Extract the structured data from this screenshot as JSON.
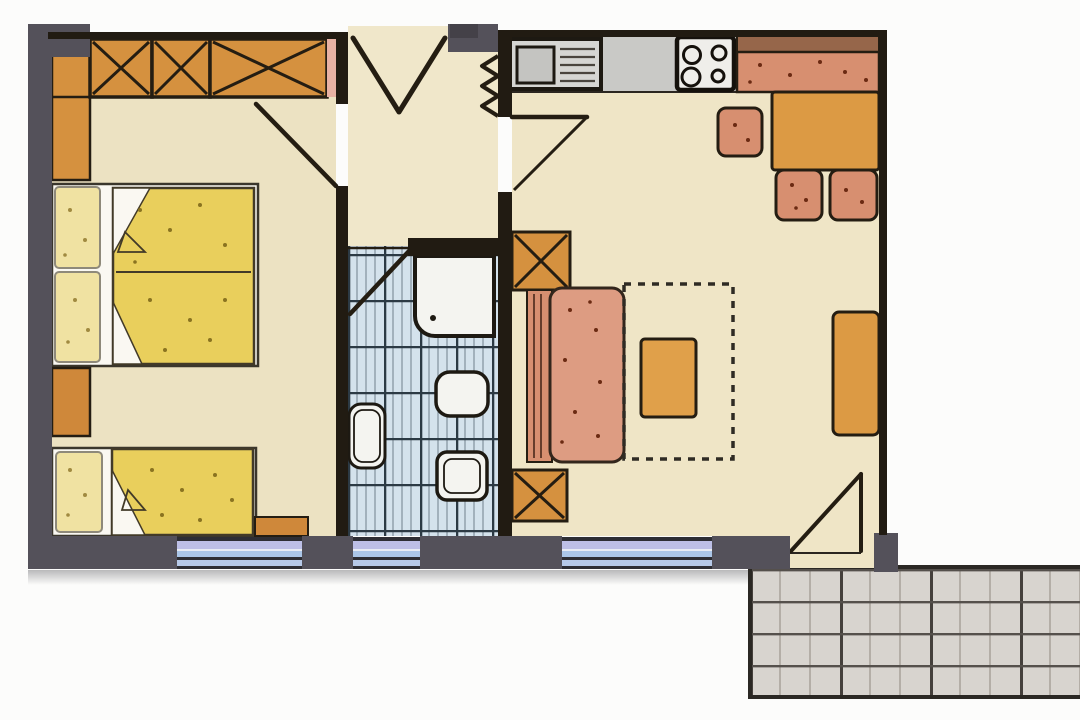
{
  "document": {
    "kind": "apartment-floor-plan-drawing",
    "text_labels": []
  },
  "palette": {
    "background": "#fcfcfb",
    "wall_gray": "#54515a",
    "wall_gray_dark": "#444148",
    "wall_dark": "#211b12",
    "floor_cream": "#ece2c2",
    "floor_cream_light": "#f0e7ca",
    "furniture_orange": "#d5913f",
    "furniture_orange_deep": "#cf883a",
    "table_orange": "#dc9a44",
    "coffee_table_orange": "#e0a04a",
    "upholstery_salmon": "#d78f70",
    "sofa_salmon": "#dd9c82",
    "bench_top_brown": "#96664a",
    "bed_yellow": "#e9cf5c",
    "pillow_cream": "#f0e2a2",
    "linen_white": "#faf8f2",
    "bath_tile_blue": "#d4e2ec",
    "fixture_white": "#f4f4f0",
    "counter_gray": "#c9c9c6",
    "sink_gray": "#d6d6d3",
    "window_periwinkle": "#bdbfe6",
    "window_blue": "#abc6e8",
    "window_blue_pale": "#b6c9e8",
    "terrace_gray": "#d8d4cf",
    "accent_pink": "#e8b2a4"
  },
  "rooms": [
    {
      "name": "bedroom",
      "furniture": [
        "wardrobe-x3",
        "side-closet",
        "double-bed",
        "nightstand",
        "single-bed",
        "side-table",
        "window"
      ]
    },
    {
      "name": "entry-hall",
      "furniture": [
        "entrance-door",
        "radiator"
      ]
    },
    {
      "name": "bathroom",
      "furniture": [
        "shower",
        "washbasin",
        "toilet",
        "bidet",
        "door",
        "window"
      ]
    },
    {
      "name": "living-room",
      "furniture": [
        "kitchen-counter",
        "sink",
        "stove",
        "corner-bench",
        "dining-table",
        "chair",
        "chair",
        "chair",
        "wall-unit-top",
        "wall-unit-bottom",
        "sofa",
        "rug",
        "coffee-table",
        "sideboard",
        "room-door",
        "balcony-door",
        "window"
      ]
    },
    {
      "name": "terrace",
      "furniture": [
        "tile-grid"
      ]
    }
  ]
}
